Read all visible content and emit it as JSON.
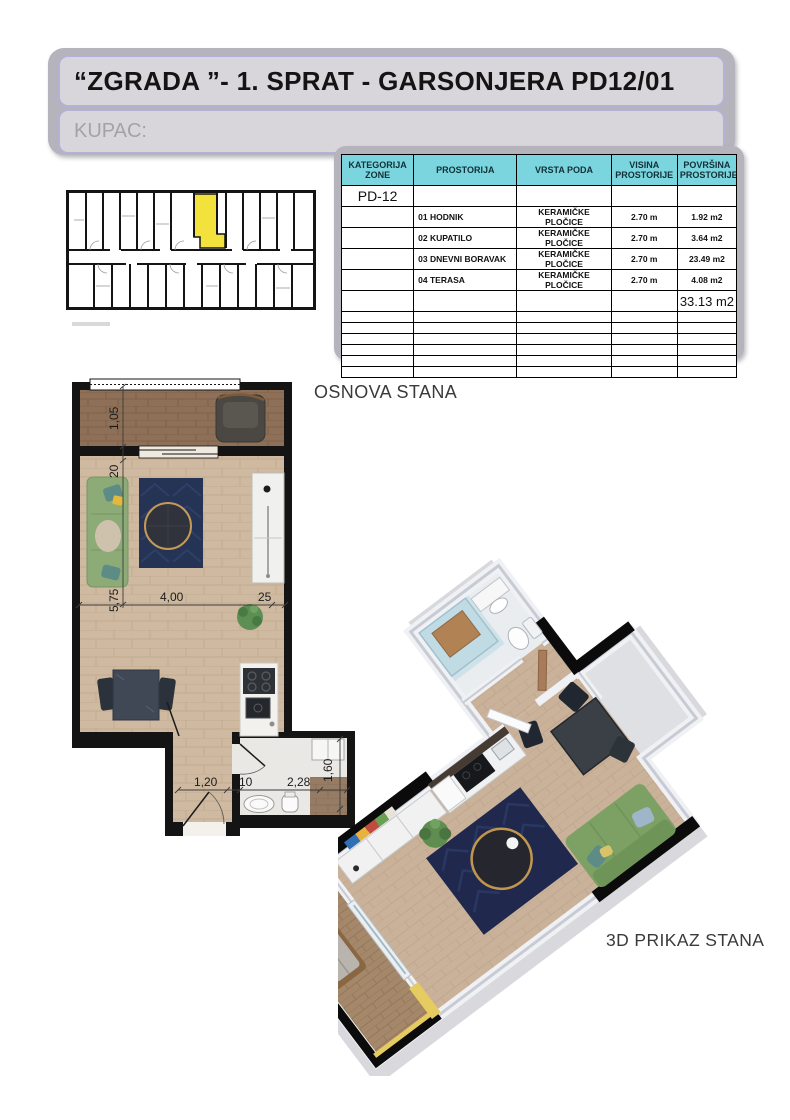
{
  "document": {
    "title": "“ZGRADA ”- 1. SPRAT - GARSONJERA PD12/01",
    "buyer_label": "KUPAC:"
  },
  "area_table": {
    "headers": {
      "zone": "KATEGORIJA ZONE",
      "room": "PROSTORIJA",
      "floor_type": "VRSTA PODA",
      "height": "VISINA PROSTORIJE",
      "area": "POVRŠINA PROSTORIJE"
    },
    "zone_code": "PD-12",
    "rows": [
      {
        "room": "01 HODNIK",
        "floor_type": "KERAMIČKE PLOČICE",
        "height": "2.70 m",
        "area": "1.92 m2"
      },
      {
        "room": "02 KUPATILO",
        "floor_type": "KERAMIČKE PLOČICE",
        "height": "2.70 m",
        "area": "3.64 m2"
      },
      {
        "room": "03 DNEVNI BORAVAK",
        "floor_type": "KERAMIČKE PLOČICE",
        "height": "2.70 m",
        "area": "23.49 m2"
      },
      {
        "room": "04 TERASA",
        "floor_type": "KERAMIČKE PLOČICE",
        "height": "2.70 m",
        "area": "4.08 m2"
      }
    ],
    "total_area": "33.13 m2"
  },
  "floor_plan": {
    "label": "OSNOVA STANA",
    "dims": {
      "terrace_depth": "1,05",
      "wall_a": "20",
      "living_length": "5,75",
      "living_width": "4,00",
      "wall_b": "25",
      "hall_width": "1,20",
      "wall_c": "10",
      "bath_width": "2,28",
      "bath_depth": "1,60"
    }
  },
  "view_3d": {
    "label": "3D PRIKAZ STANA"
  },
  "colors": {
    "table_header": "#7bd5de",
    "unit_highlight": "#f3e13c",
    "panel_gray": "#b5b3bb",
    "field_fill": "#d8d6da",
    "floor_wood": "#cfbaa1",
    "terrace_wood": "#8d7057",
    "rug_navy": "#253354",
    "sofa_green": "#8cab77"
  }
}
